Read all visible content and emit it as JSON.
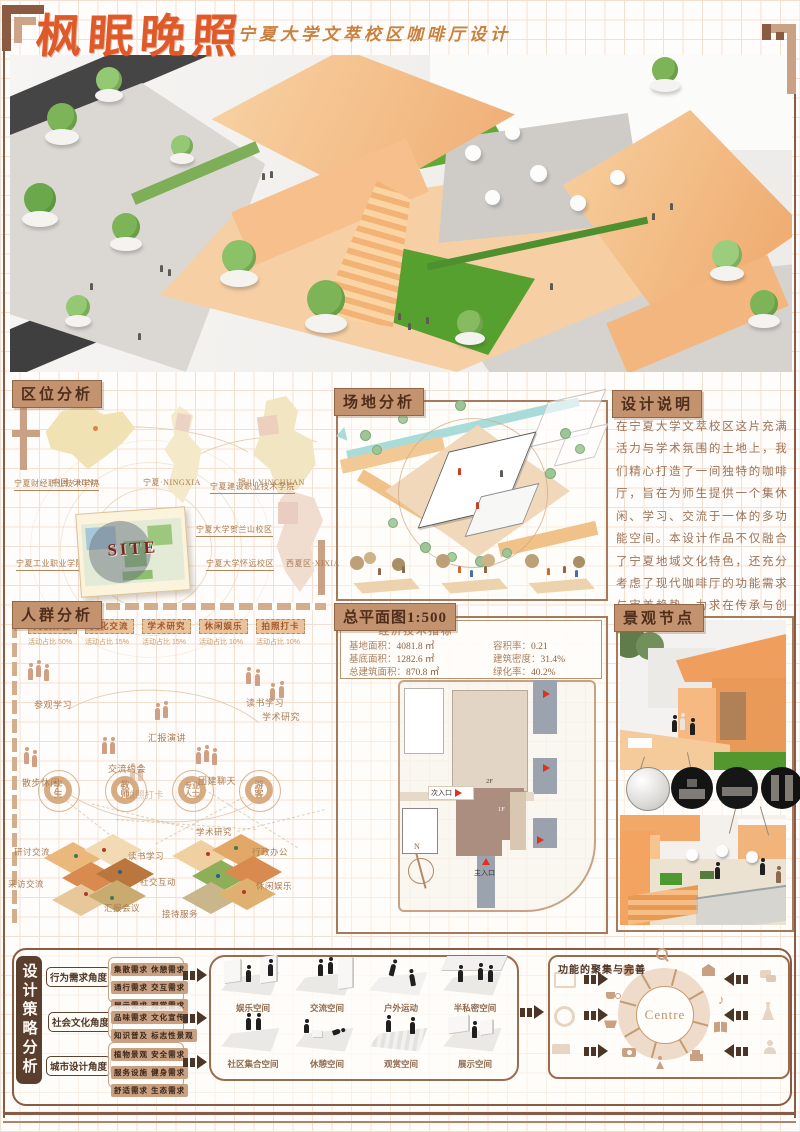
{
  "poster": {
    "title": "枫眠晚照",
    "subtitle": "宁夏大学文萃校区咖啡厅设计"
  },
  "colors": {
    "accent": "#DF5A2A",
    "frame": "#8A5A43",
    "tan": "#C9A183",
    "header_bg": "#C3936F"
  },
  "location": {
    "header": "区位分析",
    "maps": [
      {
        "label": "中国·CHINA"
      },
      {
        "label": "宁夏·NINGXIA"
      },
      {
        "label": "银川·YINCHUAN"
      }
    ],
    "site": "SITE",
    "places": [
      "宁夏财经职业技术学院",
      "宁夏建设职业技术学院",
      "宁夏大学贺兰山校区",
      "宁夏工业职业学院",
      "宁夏大学怀远校区",
      "西夏区·XIXIA"
    ]
  },
  "site_analysis": {
    "header": "场地分析"
  },
  "design_notes": {
    "header": "设计说明",
    "body": "在宁夏大学文萃校区这片充满活力与学术氛围的土地上，我们精心打造了一间独特的咖啡厅，旨在为师生提供一个集休闲、学习、交流于一体的多功能空间。本设计作品不仅融合了宁夏地域文化特色，还充分考虑了现代咖啡厅的功能需求与审美趋势，力求在传承与创新之间找到完美的平衡点。"
  },
  "crowd": {
    "header": "人群分析",
    "tags": [
      {
        "name": "阅读体验",
        "ratio": "活动占比 50%"
      },
      {
        "name": "文化交流",
        "ratio": "活动占比 15%"
      },
      {
        "name": "学术研究",
        "ratio": "活动占比 15%"
      },
      {
        "name": "休闲娱乐",
        "ratio": "活动占比 10%"
      },
      {
        "name": "拍照打卡",
        "ratio": "活动占比 10%"
      }
    ],
    "activities": [
      "参观学习",
      "交流约会",
      "汇报演讲",
      "读书学习",
      "散步休闲",
      "团建聊天",
      "拍照打卡",
      "学术研究"
    ],
    "groups": [
      "学生",
      "教师",
      "专业人士",
      "游客"
    ],
    "axon_left": [
      "研讨交流",
      "采访交流",
      "读书学习",
      "社交互动",
      "汇报会议"
    ],
    "axon_right": [
      "学术研究",
      "行政办公",
      "休闲娱乐",
      "接待服务"
    ]
  },
  "master_plan": {
    "header": "总平面图1:500",
    "indicators_title": "经济技术指标",
    "indicators": [
      {
        "label": "基地面积：",
        "value": "4081.8 ㎡"
      },
      {
        "label": "容积率：",
        "value": "0.21"
      },
      {
        "label": "基底面积：",
        "value": "1282.6 ㎡"
      },
      {
        "label": "建筑密度：",
        "value": "31.4%"
      },
      {
        "label": "总建筑面积：",
        "value": "870.8 ㎡"
      },
      {
        "label": "绿化率：",
        "value": "40.2%"
      }
    ],
    "plan": {
      "secondary_entrance": "次入口",
      "main_entrance": "主入口",
      "floor2": "2F",
      "floor1": "1F",
      "north": "N"
    }
  },
  "landscape": {
    "header": "景观节点"
  },
  "strategy": {
    "header": "设计策略分析",
    "rows": [
      {
        "angle": "行为需求角度",
        "needs": [
          "集散需求 休憩需求",
          "通行需求 交互需求",
          "展示需求 观赏需求"
        ]
      },
      {
        "angle": "社会文化角度",
        "needs": [
          "品味需求 文化宣传",
          "知识普及 标志性景观"
        ]
      },
      {
        "angle": "城市设计角度",
        "needs": [
          "植物景观 安全需求",
          "服务设施 健身需求",
          "舒适需求 生态需求"
        ]
      }
    ],
    "spaces1": [
      "娱乐空间",
      "交流空间",
      "户外运动",
      "半私密空间"
    ],
    "spaces2": [
      "社区集合空间",
      "休憩空间",
      "观赏空间",
      "展示空间"
    ],
    "function_title": "功能的聚集与完善",
    "centre": "Centre"
  }
}
